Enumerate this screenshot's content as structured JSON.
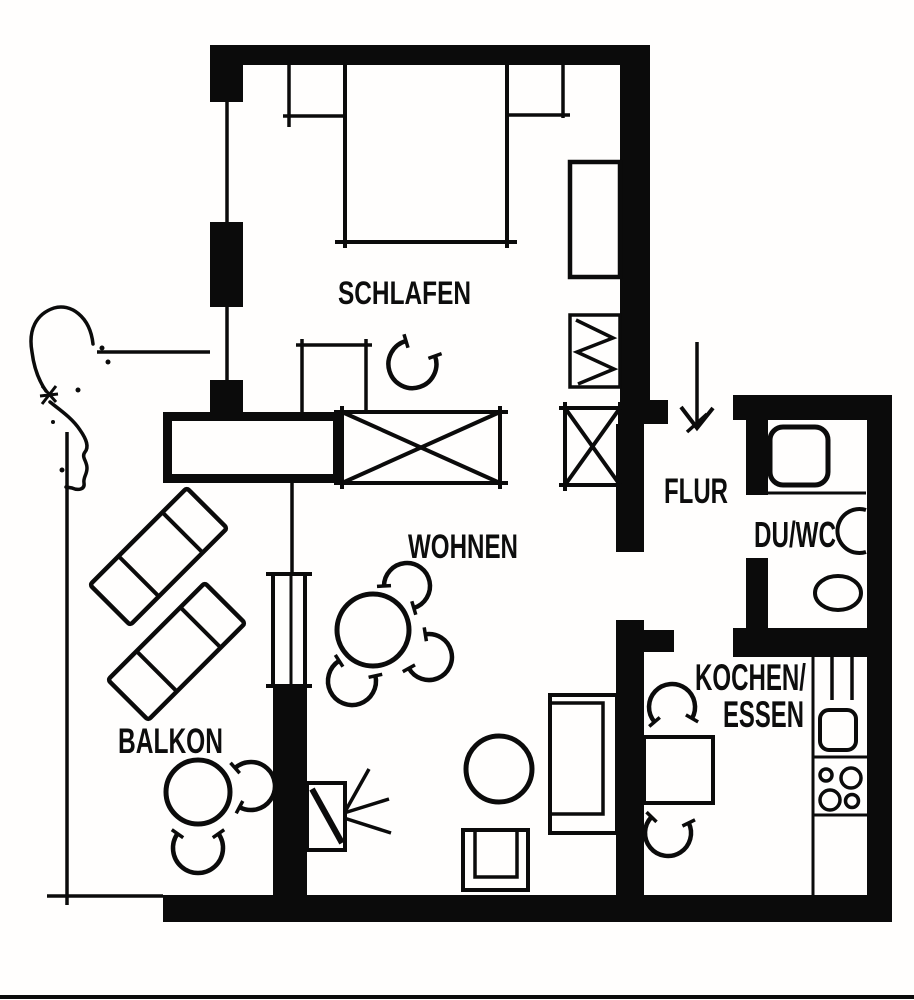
{
  "document": {
    "type": "apartment floor plan",
    "style": "black ink line drawing on white paper"
  },
  "colors": {
    "ink": "#0b0b0b",
    "paper": "#fffefd"
  },
  "rooms": {
    "schlafen": {
      "label": "SCHLAFEN"
    },
    "wohnen": {
      "label": "WOHNEN"
    },
    "flur": {
      "label": "FLUR"
    },
    "du_wc": {
      "label": "DU/WC"
    },
    "kochen_essen": {
      "label_line1": "KOCHEN/",
      "label_line2": "ESSEN"
    },
    "balkon": {
      "label": "BALKON"
    }
  },
  "symbols": [
    "entrance-arrow",
    "double-bed",
    "bedside-shelves",
    "wardrobe",
    "radiator-zigzag-cabinet",
    "crossed-wardrobe-left",
    "crossed-wardrobe-right",
    "sideboard-thick-box",
    "dressing-table",
    "dressing-chair-arc",
    "shower-tray",
    "washbasin",
    "toilet",
    "kitchen-counter",
    "kitchen-sink",
    "stove-four-burners",
    "kitchen-table",
    "kitchen-chair-north",
    "kitchen-chair-south",
    "dining-table-round",
    "dining-chair-north",
    "dining-chair-east",
    "dining-chair-southwest",
    "sofa",
    "armchair-round",
    "side-table-square",
    "tv-with-rays",
    "balcony-door",
    "sun-lounger-1",
    "sun-lounger-2",
    "balcony-table-round",
    "balcony-chair-east",
    "balcony-chair-south",
    "tree-sketch"
  ]
}
